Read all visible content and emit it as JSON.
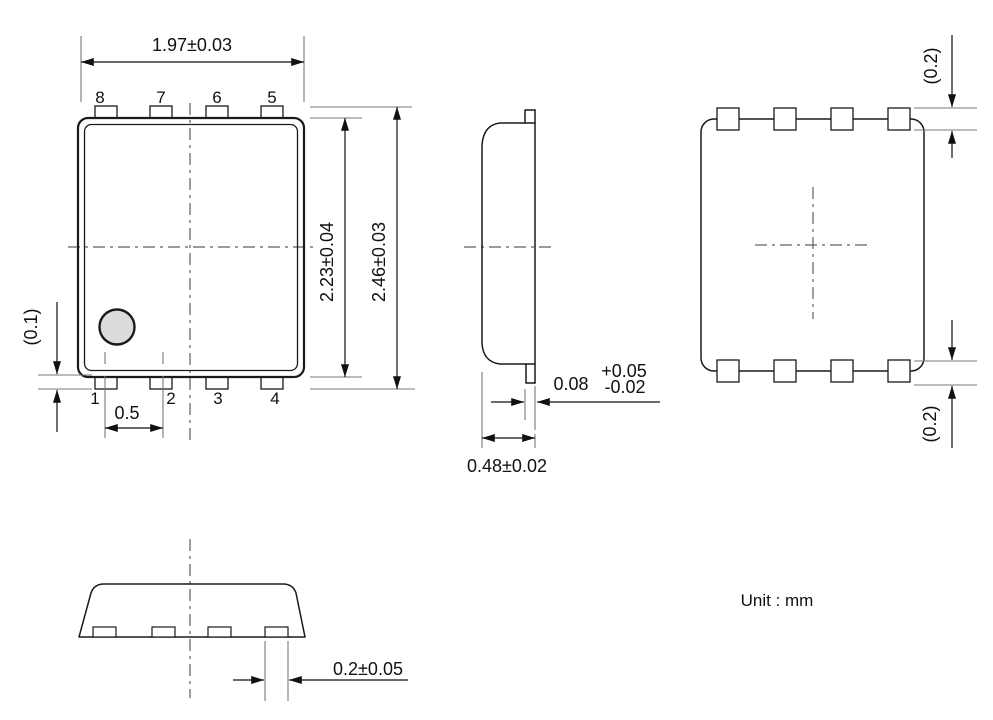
{
  "unit_label": "Unit : mm",
  "colors": {
    "line": "#1a1a1a",
    "extension_line": "#7a7a7a",
    "centerline": "#5f5f5f",
    "pin1_marker_fill": "#dcdcdc",
    "background": "#ffffff"
  },
  "front_view": {
    "pin_labels_top": [
      "8",
      "7",
      "6",
      "5"
    ],
    "pin_labels_bottom": [
      "1",
      "2",
      "3",
      "4"
    ],
    "dims": {
      "width": "1.97±0.03",
      "body_height": "2.23±0.04",
      "overall_height": "2.46±0.03",
      "lead_standoff": "(0.1)",
      "lead_pitch": "0.5"
    }
  },
  "side_view": {
    "dims": {
      "lead_thickness": "0.08",
      "lead_thickness_tol_plus": "+0.05",
      "lead_thickness_tol_minus": "-0.02",
      "package_thickness": "0.48±0.02"
    }
  },
  "back_view": {
    "dims": {
      "pad_size_top": "(0.2)",
      "pad_size_bottom": "(0.2)"
    }
  },
  "bottom_view": {
    "dims": {
      "pad_width": "0.2±0.05"
    }
  }
}
